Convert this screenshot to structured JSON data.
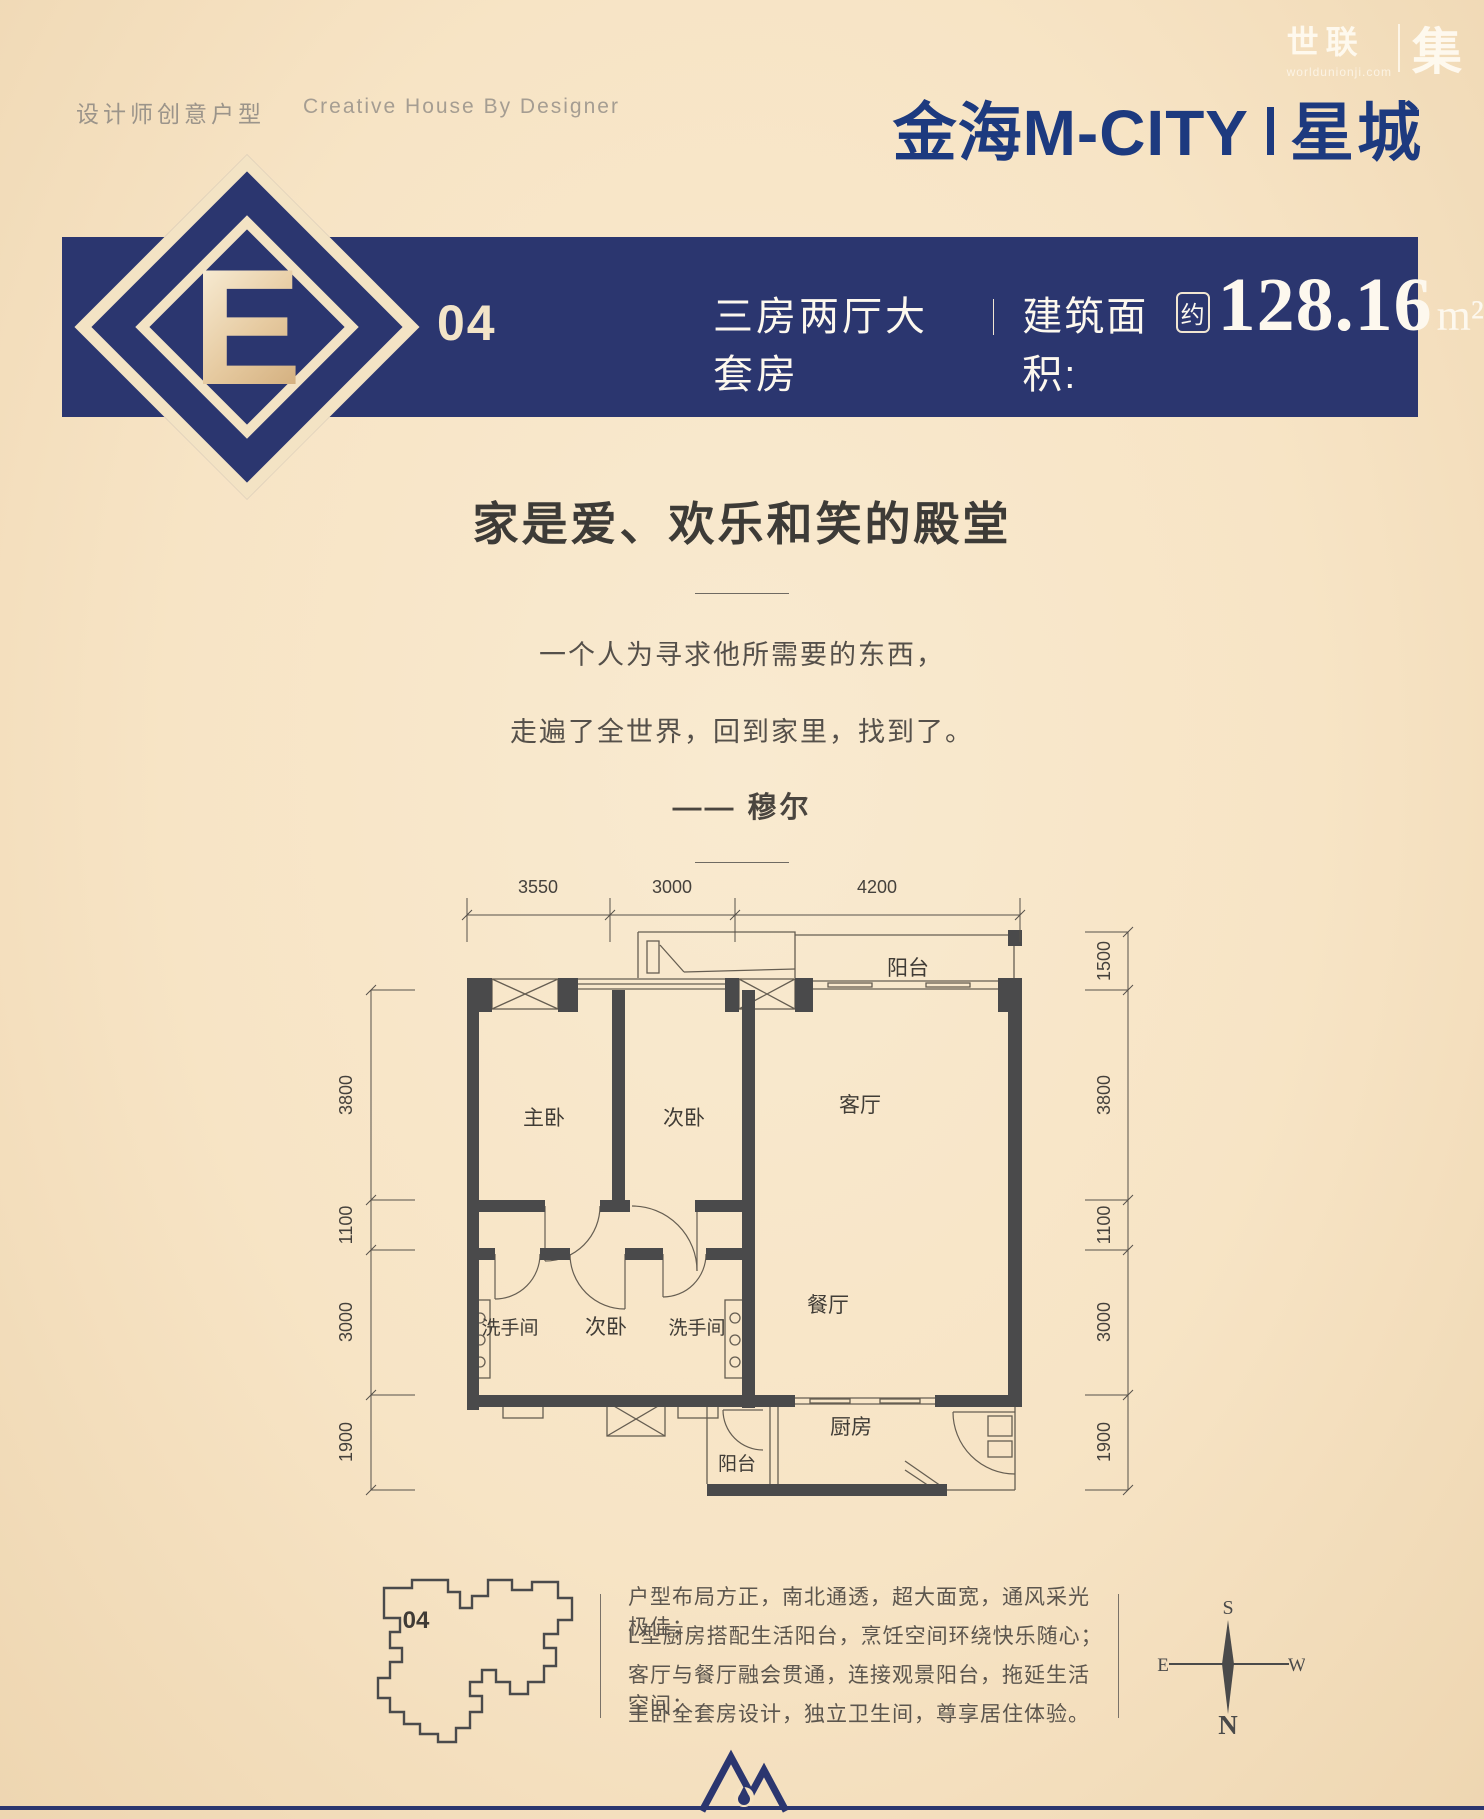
{
  "brand": {
    "name_cn": "世联",
    "domain": "worldunionji.com",
    "suffix": "集"
  },
  "header": {
    "tagline_cn": "设计师创意户型",
    "tagline_en": "Creative House By Designer",
    "title_main": "金海M-CITY",
    "title_sub": "星城"
  },
  "banner": {
    "unit_letter": "E",
    "unit_number": "04",
    "type_label": "三房两厅大套房",
    "area_label": "建筑面积:",
    "area_prefix": "约",
    "area_value": "128.16",
    "area_unit": "m²"
  },
  "intro": {
    "heading": "家是爱、欢乐和笑的殿堂",
    "quote_line1": "一个人为寻求他所需要的东西，",
    "quote_line2": "走遍了全世界，回到家里，找到了。",
    "quote_author": "——  穆尔"
  },
  "floorplan": {
    "dims_top": [
      "3550",
      "3000",
      "4200"
    ],
    "dims_left": [
      "3800",
      "1100",
      "3000",
      "1900"
    ],
    "dims_right": [
      "1500",
      "3800",
      "1100",
      "3000",
      "1900"
    ],
    "rooms": {
      "balcony_top": "阳台",
      "master_bed": "主卧",
      "bed2": "次卧",
      "living": "客厅",
      "bath_left": "洗手间",
      "bed3": "次卧",
      "bath_right": "洗手间",
      "dining": "餐厅",
      "kitchen": "厨房",
      "balcony_bottom": "阳台"
    }
  },
  "footer": {
    "siteplan_unit": "04",
    "desc_lines": [
      "户型布局方正，南北通透，超大面宽，通风采光极佳；",
      "L型厨房搭配生活阳台，烹饪空间环绕快乐随心；",
      "客厅与餐厅融会贯通，连接观景阳台，拖延生活空间；",
      "主卧全套房设计，独立卫生间，尊享居住体验。"
    ],
    "compass": {
      "n": "N",
      "s": "S",
      "e": "E",
      "w": "W"
    }
  },
  "colors": {
    "navy": "#2b366f",
    "title_navy": "#1d3a7f",
    "cream": "#f3e3c4",
    "wall": "#4a4a4b"
  }
}
